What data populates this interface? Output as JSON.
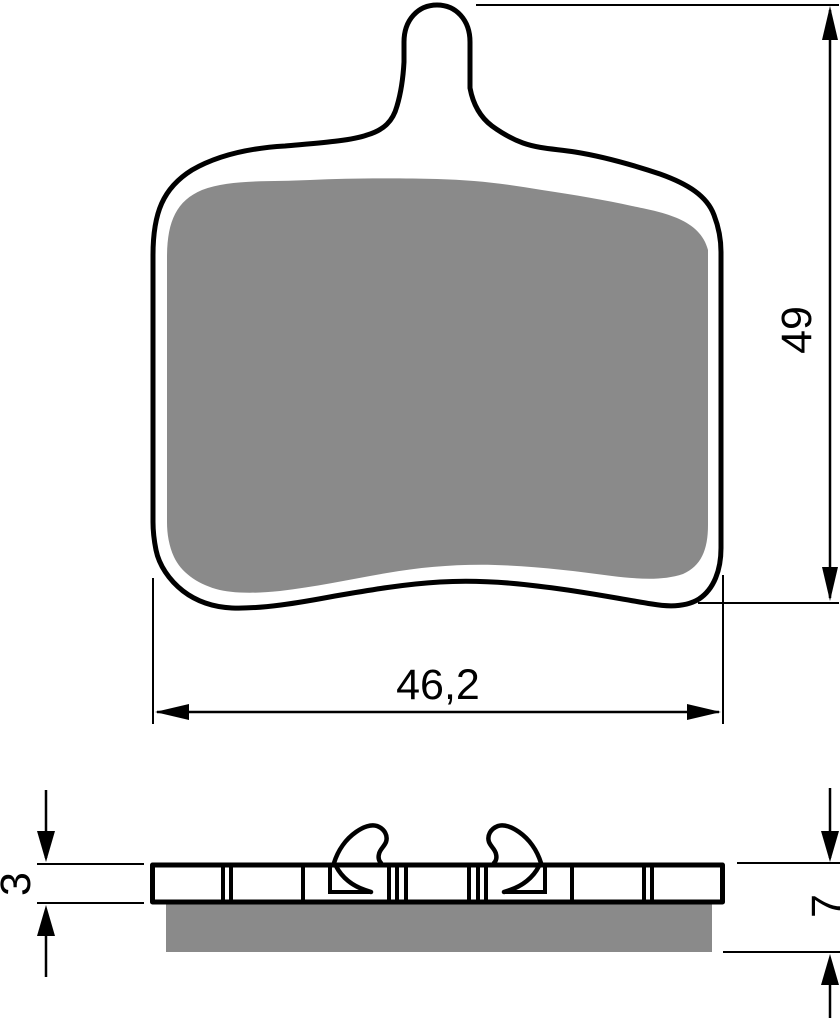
{
  "dimensions": {
    "front_height": "49",
    "front_width": "46,2",
    "side_plate_thickness": "3",
    "side_total_thickness": "7"
  },
  "colors": {
    "line": "#000000",
    "friction_material": "#8a8a8a",
    "background": "#ffffff"
  }
}
